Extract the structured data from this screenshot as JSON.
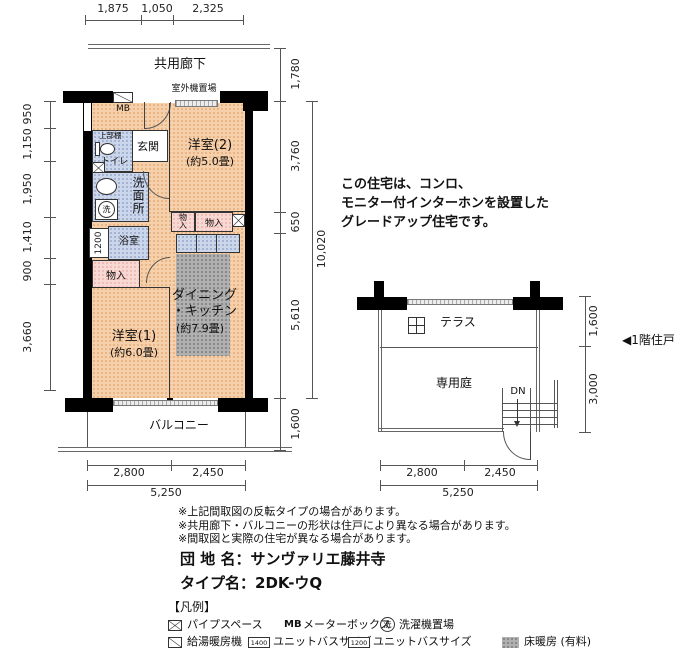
{
  "colors": {
    "room_peach": "#f6cfab",
    "wet_area_blue": "#ccd6ea",
    "closet_pink": "#f8d8d3",
    "floor_heating_gray": "#b0b0b0",
    "wall_black": "#000000"
  },
  "floorplan": {
    "corridor_label": "共用廊下",
    "outdoor_unit_label": "室外機置場",
    "mb_label": "MB",
    "entrance_label": "玄関",
    "upper_shelf_label": "上部棚",
    "toilet_label": "トイレ",
    "washroom_label": "洗面所",
    "laundry_symbol": "洗",
    "bath_label": "浴室",
    "bath_size": "1200",
    "closet_small_label": "物入",
    "closet_wide_label": "物入",
    "closet_lower_label": "物入",
    "room2_label": "洋室(2)",
    "room2_size": "(約5.0畳)",
    "room1_label": "洋室(1)",
    "room1_size": "(約6.0畳)",
    "dk_label_line1": "ダイニング",
    "dk_label_line2": "・キッチン",
    "dk_size": "(約7.9畳)",
    "balcony_label": "バルコニー",
    "dims_top": [
      "1,875",
      "1,050",
      "2,325"
    ],
    "dims_left": [
      "950",
      "1,150",
      "1,950",
      "1,410",
      "900",
      "3,660"
    ],
    "dims_right": [
      "1,780",
      "3,760",
      "650",
      "5,610",
      "1,600"
    ],
    "dim_right_total": "10,020",
    "dims_bottom": [
      "2,800",
      "2,450"
    ],
    "dim_bottom_total": "5,250"
  },
  "ground_floor": {
    "terrace_label": "テラス",
    "garden_label": "専用庭",
    "down_label": "DN",
    "marker_label": "◀1階住戸",
    "dims_right": [
      "1,600",
      "3,000"
    ],
    "dims_bottom": [
      "2,800",
      "2,450"
    ],
    "dim_bottom_total": "5,250"
  },
  "description_lines": [
    "この住宅は、コンロ、",
    "モニター付インターホンを設置した",
    "グレードアップ住宅です。"
  ],
  "notes": [
    "※上記間取図の反転タイプの場合があります。",
    "※共用廊下・バルコニーの形状は住戸により異なる場合があります。",
    "※間取図と実際の住宅が異なる場合があります。"
  ],
  "property": {
    "estate_label": "団 地 名：サンヴァリエ藤井寺",
    "type_label": "タイプ名：2DK-ウQ"
  },
  "legend": {
    "title": "【凡例】",
    "pipe_space": "パイプスペース",
    "mb_abbr": "MB",
    "meter_box": "メーターボックス",
    "laundry_symbol": "洗",
    "laundry_space": "洗濯機置場",
    "water_heater": "給湯暖房機",
    "bath_1400": "1400",
    "unit_bath_label_1": "ユニットバスサイズ",
    "bath_1200": "1200",
    "unit_bath_label_2": "ユニットバスサイズ",
    "floor_heating": "床暖房 (有料)"
  }
}
